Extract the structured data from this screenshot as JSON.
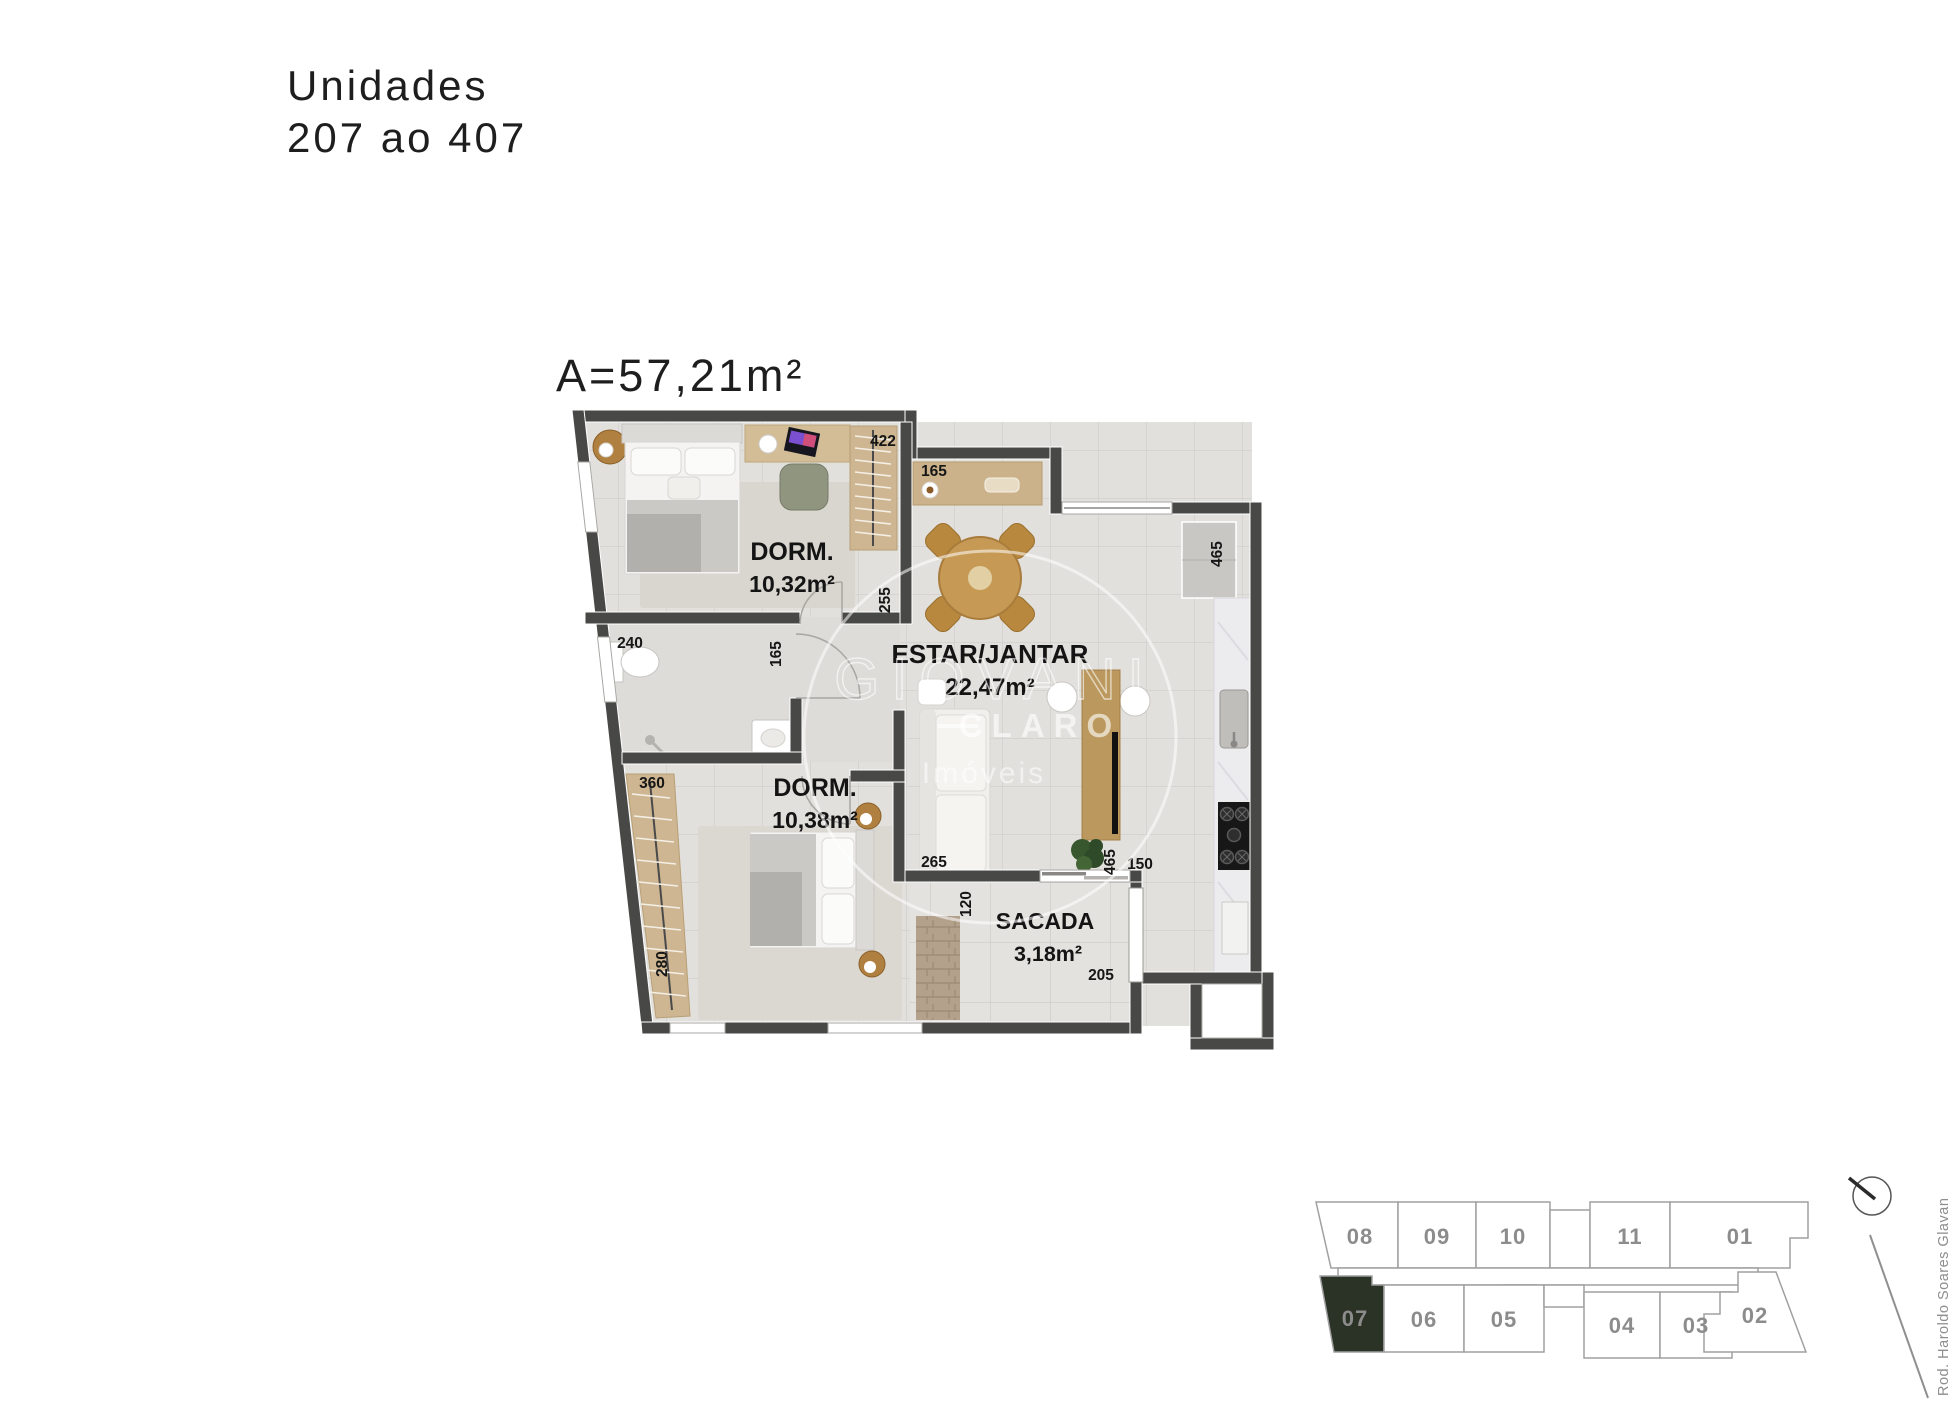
{
  "title": {
    "line1": "Unidades",
    "line2": "207 ao 407"
  },
  "plan": {
    "area_label": "A=57,21m²",
    "rooms": {
      "dorm1": {
        "name": "DORM.",
        "area": "10,32m²"
      },
      "dorm2": {
        "name": "DORM.",
        "area": "10,38m²"
      },
      "living": {
        "name": "ESTAR/JANTAR",
        "area": "22,47m²"
      },
      "sacada": {
        "name": "SACADA",
        "area": "3,18m²"
      }
    },
    "dims": {
      "wardrobe1": "422",
      "sideboard": "165",
      "fridge": "465",
      "living_left": "255",
      "bath_door": "165",
      "bath_top": "240",
      "wardrobe2_top": "360",
      "wardrobe2_side": "280",
      "sofa_bottom": "265",
      "sacada_left": "120",
      "tv_bar": "465",
      "kitchen_bottom": "150",
      "sacada_bottom": "205"
    }
  },
  "watermark": {
    "line1": "GIOVANI",
    "line2": "CLARO",
    "line3": "Imóveis"
  },
  "keyplan": {
    "street": "Rod. Haroldo Soares Glavan",
    "units_top": [
      "08",
      "09",
      "10",
      "11",
      "01"
    ],
    "units_bottom": [
      "07",
      "06",
      "05",
      "04",
      "03",
      "02"
    ],
    "highlighted_unit": "07",
    "highlight_color": "#2b3226",
    "line_color": "#9e9e9e"
  }
}
